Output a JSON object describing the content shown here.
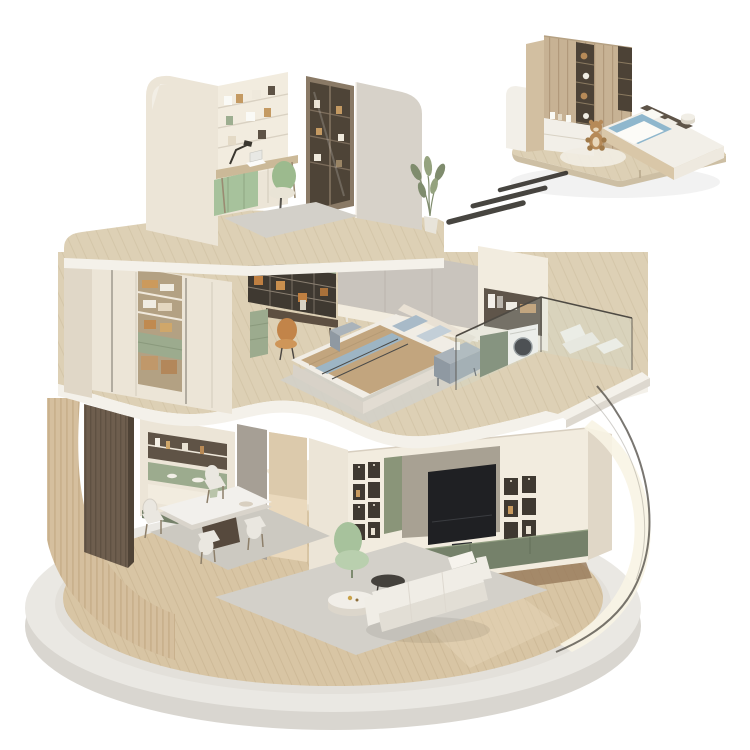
{
  "scene": {
    "type": "isometric-3d-home-cutaway-render",
    "floors": [
      {
        "name": "top-floor-study",
        "furniture": [
          "curved-left-wall",
          "built-in-shelving",
          "desk",
          "laptop",
          "desk-lamp",
          "green-bench",
          "office-chair",
          "glass-bookcase",
          "curved-right-wall",
          "potted-plant",
          "rug"
        ]
      },
      {
        "name": "middle-floor-bedroom",
        "furniture": [
          "wardrobe",
          "folded-clothes",
          "green-drawers",
          "storage-baskets",
          "vanity-shelves",
          "vanity-desk",
          "orange-chair",
          "floor-lamp",
          "fabric-wall",
          "double-bed",
          "pillows",
          "blanket",
          "nightstand",
          "laundry-niche",
          "washing-machine",
          "green-cabinet",
          "balcony-glass-railing",
          "lounge-chair"
        ]
      },
      {
        "name": "ground-floor-living-dining",
        "furniture": [
          "slatted-curved-wall",
          "walnut-panel",
          "display-cabinet",
          "dining-rug",
          "dining-table",
          "dining-chairs",
          "vase-of-flowers",
          "gray-pillar",
          "corridor",
          "tv-wall",
          "television",
          "media-niches",
          "green-base-cabinet",
          "living-rug",
          "sofa",
          "marble-coffee-table",
          "dark-side-table",
          "recliner"
        ]
      }
    ],
    "detached_module": {
      "name": "kids-bedroom-module",
      "furniture": [
        "plank-wardrobe",
        "toy-shelves",
        "drawer-base",
        "platform-bed",
        "blue-bedding",
        "teddy-bear",
        "round-rug",
        "stool"
      ]
    },
    "effects": [
      "motion-lines",
      "curved-glass-screen",
      "round-stone-platform"
    ]
  },
  "colors": {
    "page_bg": "#ffffff",
    "platform_top": "#eae8e3",
    "platform_side": "#d9d6d0",
    "platform_inner": "#e3e0da",
    "floor_wood": "#d8c5a4",
    "floor_wood_line": "#c6b08d",
    "slab_wood": "#ddd0b5",
    "slab_wood_line": "#cabb9b",
    "slab_edge": "#f4f1ea",
    "slat_wood": "#d5bf9e",
    "slat_line": "#bfa680",
    "walnut": "#6e5e4e",
    "walnut_line": "#594b3e",
    "wall_cream": "#ece5d7",
    "wall_cream_light": "#f2ecdf",
    "wall_cream_dark": "#e0d7c7",
    "wall_gray": "#c9c4bd",
    "wall_gray_light": "#d7d2c9",
    "pillar_gray": "#a69f95",
    "corridor_light": "#ead9bd",
    "shelf_dark": "#3f3931",
    "shelf_bronze": "#5f5346",
    "cabinet_green": "#75816a",
    "cabinet_green2": "#9cab8e",
    "green_panel": "#8a9579",
    "tv_backing": "#a8a193",
    "tv_black": "#1f2023",
    "rug": "#d3d0c9",
    "rug_dining": "#ccc9c1",
    "sofa": "#f0ede6",
    "sofa_shade": "#e2ded5",
    "table_white": "#f2f0ec",
    "table_marble": "#f1eee8",
    "table_dark": "#44413c",
    "chair_white": "#eae7e0",
    "chair_green": "#9cba8e",
    "chair_orange": "#c28449",
    "recliner": "#a7c29c",
    "recliner_light": "#b9cfae",
    "bed_white": "#f1ede5",
    "pillow_blue": "#a8bac8",
    "pillow_blue2": "#c3cfd8",
    "blanket_tan": "#c2a57e",
    "blanket_stripe": "#9db5c4",
    "headboard": "#e9e1d4",
    "nightstand": "#8f99a2",
    "nightstand_top": "#aab3ba",
    "closet_interior": "#b3a183",
    "basket_tan": "#c0986a",
    "laundry_dark": "#5f554a",
    "washer_white": "#f4f2ee",
    "washer_door": "#2d2e32",
    "glass_fill": "#cfe0de",
    "glass_line": "#4e4a43",
    "module_wood": "#c7b294",
    "module_wood_line": "#ab9274",
    "module_end": "#d2bfa1",
    "module_dark": "#4c4236",
    "module_white": "#f2efe8",
    "module_bed_blue": "#8fb7cd",
    "module_head": "#5e5448",
    "bear_brown": "#b68a58",
    "bear_light": "#e8d7ba",
    "motion": "#34312c",
    "dome_wall": "#f8f4e4",
    "dome_line": "#4c4841",
    "plant_green": "#7f8c6d",
    "plant_green2": "#95a37f",
    "lamp_dark": "#3a372f",
    "book_orange": "#bf7f41",
    "floor_dark_walk": "#97795a"
  }
}
